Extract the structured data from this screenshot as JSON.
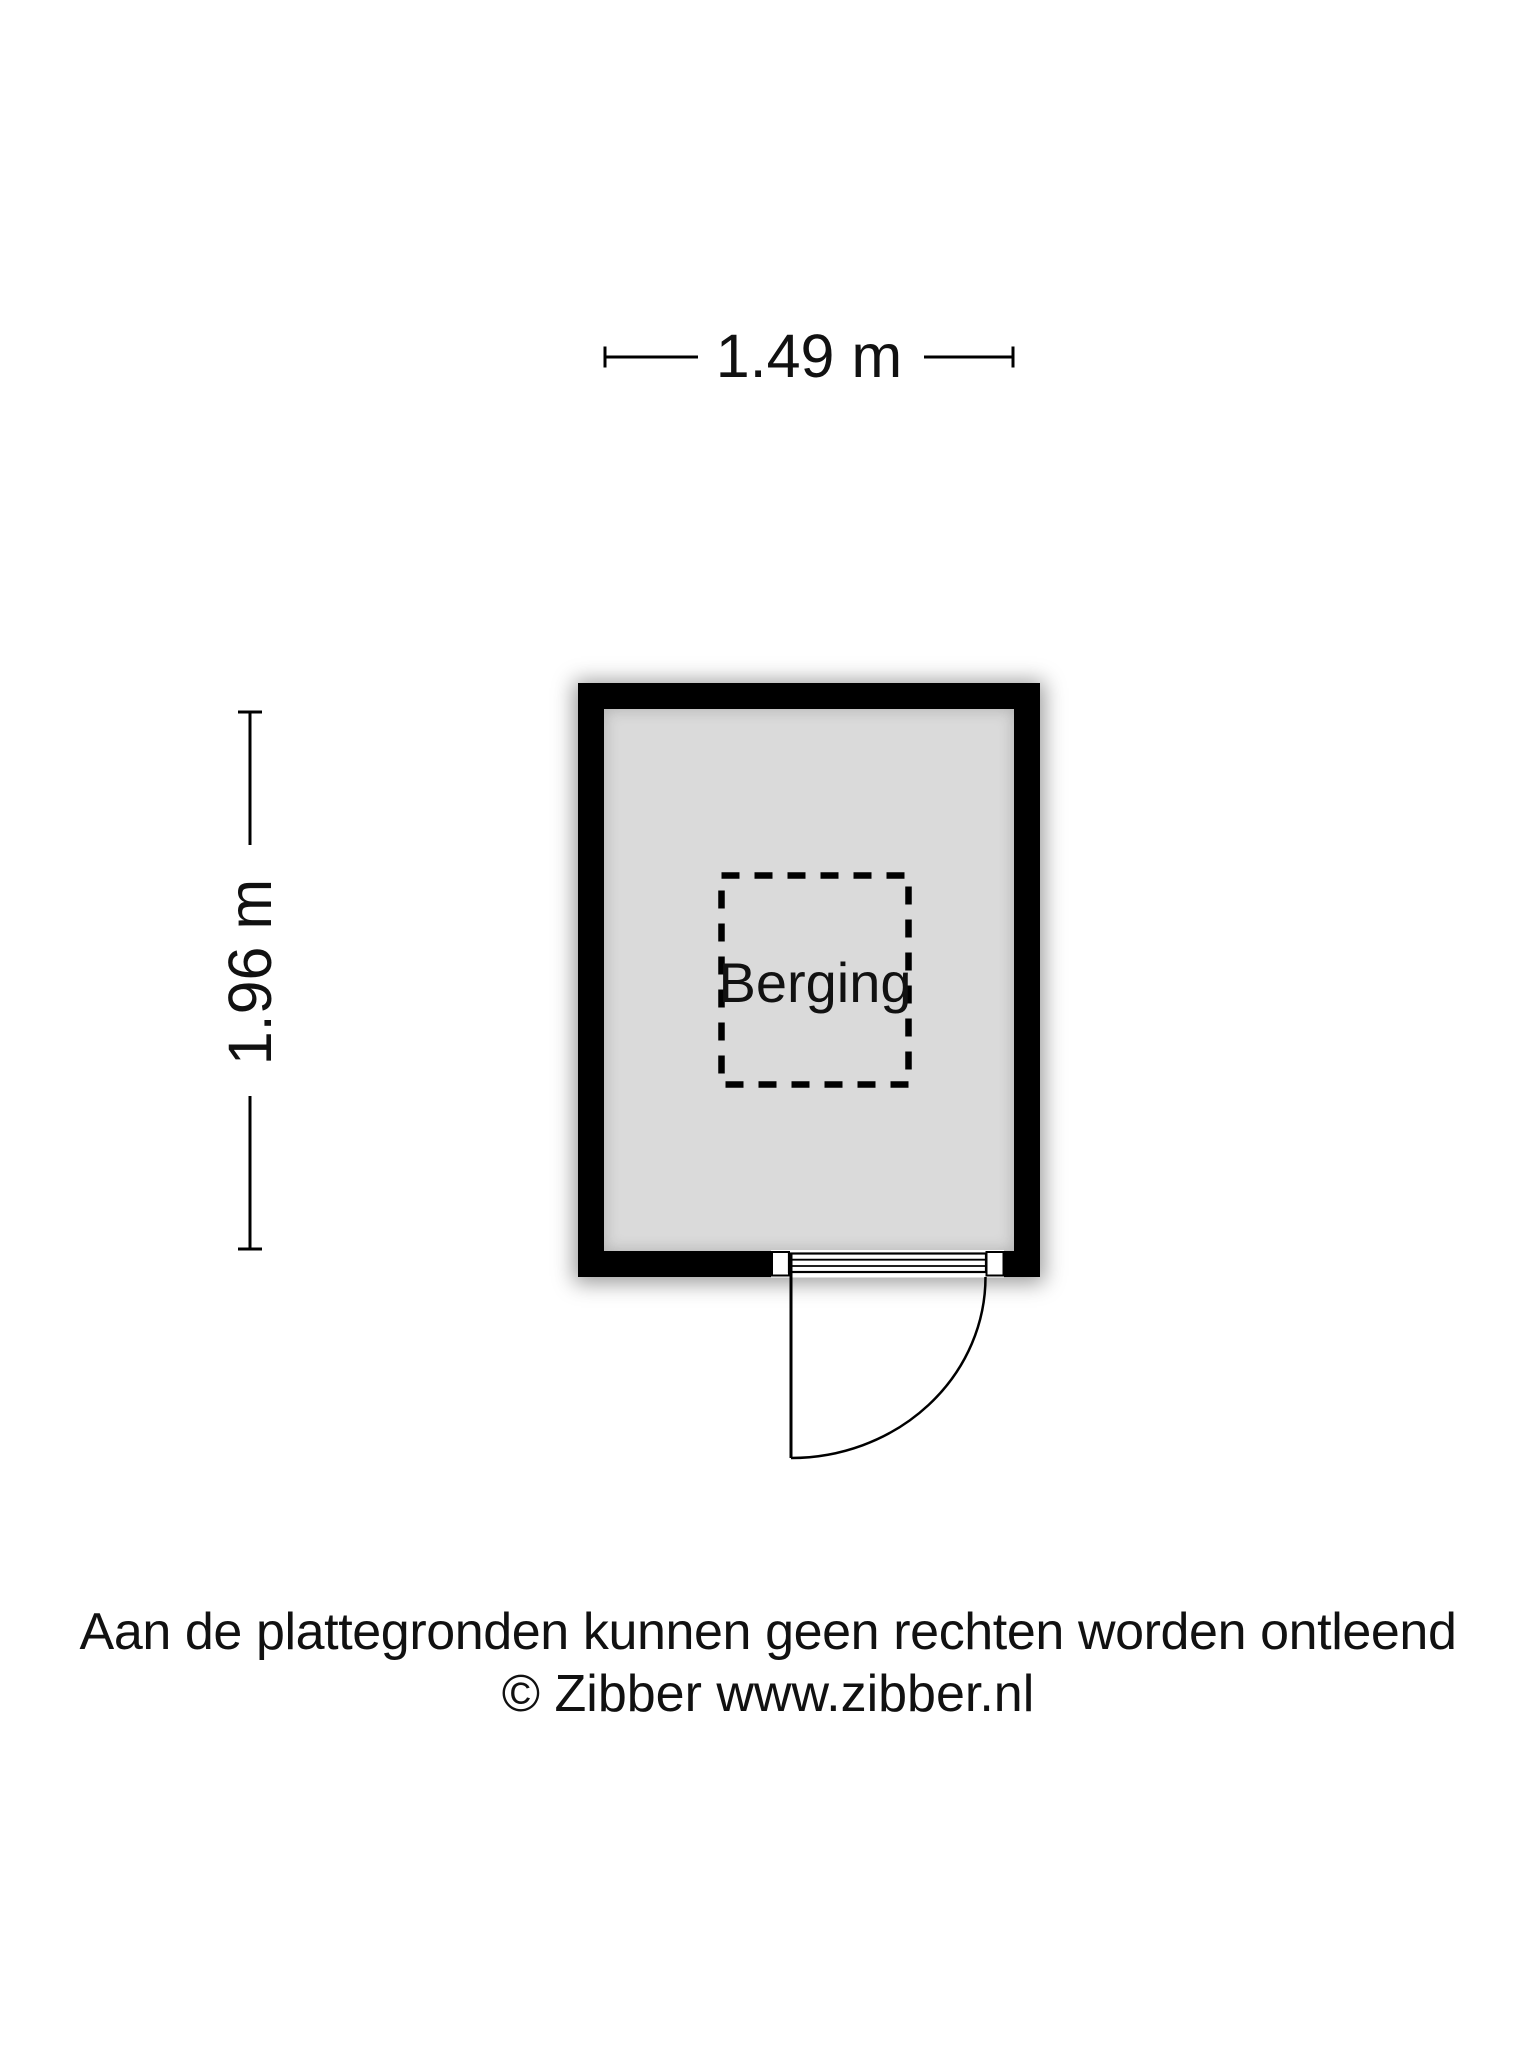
{
  "plan": {
    "rooms": [
      {
        "name": "Berging"
      }
    ],
    "dimensions": {
      "width_label": "1.49 m",
      "height_label": "1.96 m"
    }
  },
  "footer": {
    "disclaimer": "Aan de plattegronden kunnen geen rechten worden ontleend",
    "copyright": "© Zibber www.zibber.nl"
  },
  "colors": {
    "wall": "#000000",
    "floor": "#dadada",
    "line": "#000000",
    "text": "#111111",
    "background": "#ffffff"
  }
}
